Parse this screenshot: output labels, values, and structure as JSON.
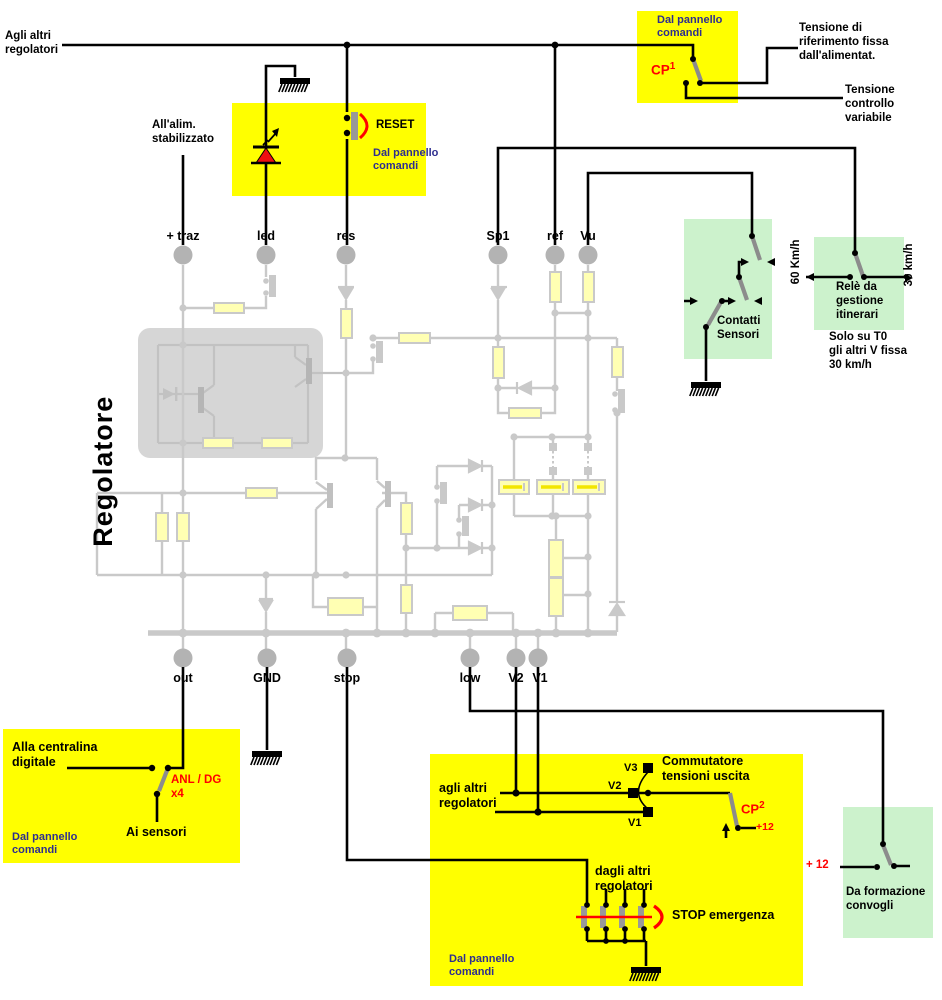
{
  "colors": {
    "box_yellow": "#ffff00",
    "box_green": "#ccf2cc",
    "accent_red": "#ff0000",
    "panel_text_navy": "#2e2e8f",
    "faded_circuit_gray": "#c9c9c9",
    "resistor_fill": "#ffffb3"
  },
  "header": {
    "agli_altri": "Agli altri\nregolatori",
    "alim": "All'alim.\nstabilizzato",
    "title": "Regolatore"
  },
  "cp1_box": {
    "panel": "Dal pannello\ncomandi",
    "cp": "CP",
    "number": "1"
  },
  "right_labels": {
    "fixed": "Tensione di\nriferimento fissa\ndall'alimentat.",
    "variable": "Tensione\ncontrollo\nvariabile"
  },
  "reset_box": {
    "reset": "RESET",
    "panel": "Dal pannello\ncomandi"
  },
  "terminals": {
    "top": [
      "+ traz",
      "led",
      "res",
      "Sp1",
      "ref",
      "Vu"
    ],
    "bottom": [
      "out",
      "GND",
      "stop",
      "low",
      "V2",
      "V1"
    ]
  },
  "contatti_box": {
    "label": "Contatti\nSensori"
  },
  "rele_box": {
    "label": "Relè da\ngestione\nitinerari",
    "left_speed": "60 Km/h",
    "right_speed": "30 km/h",
    "note": "Solo su T0\ngli altri V fissa\n30 km/h"
  },
  "out_box": {
    "alla": "Alla centralina\ndigitale",
    "anl": "ANL / DG\nx4",
    "ai": "Ai sensori",
    "panel": "Dal pannello\ncomandi"
  },
  "comm_box": {
    "agli": "agli altri\nregolatori",
    "title": "Commutatore\ntensioni uscita",
    "v3": "V3",
    "v2": "V2",
    "v1": "V1",
    "cp": "CP",
    "number": "2",
    "p12": "+12",
    "dagli": "dagli altri\nregolatori",
    "stop": "STOP emergenza",
    "panel": "Dal pannello\ncomandi"
  },
  "formazione_box": {
    "label": "Da formazione\nconvogli",
    "p12": "+ 12"
  }
}
